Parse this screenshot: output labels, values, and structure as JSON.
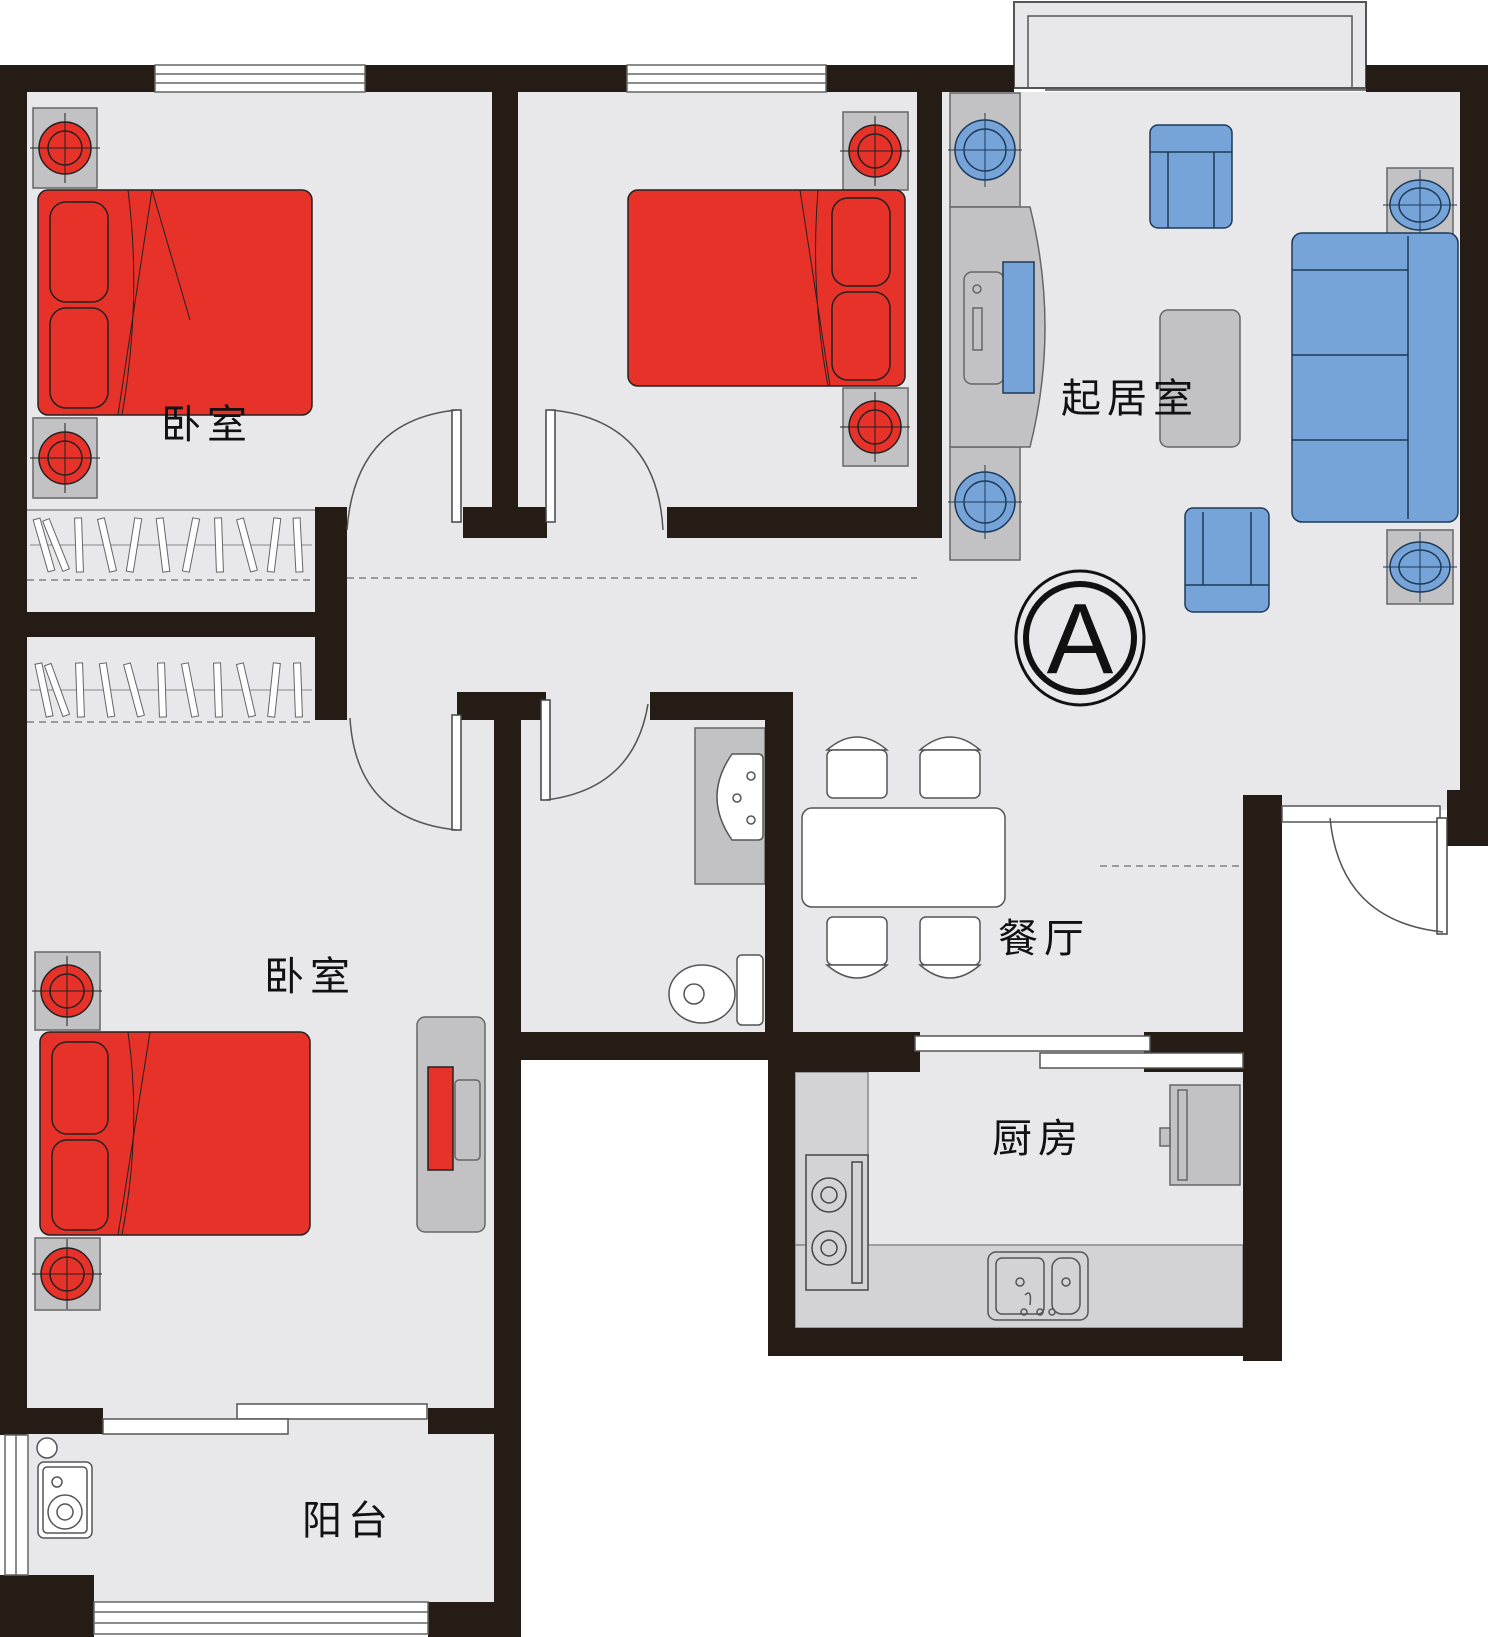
{
  "floorplan": {
    "unit_marker": "A",
    "labels": {
      "bedroom_top_left": "卧室",
      "bedroom_bottom_left": "卧室",
      "living_room": "起居室",
      "dining_room": "餐厅",
      "kitchen": "厨房",
      "balcony": "阳台"
    },
    "colors": {
      "wall": "#241c15",
      "floor": "#e8e8ea",
      "bed_red": "#e73229",
      "furniture_blue": "#76a3d8",
      "furniture_gray": "#c2c2c4",
      "counter_gray": "#d3d3d5",
      "white": "#ffffff"
    }
  }
}
